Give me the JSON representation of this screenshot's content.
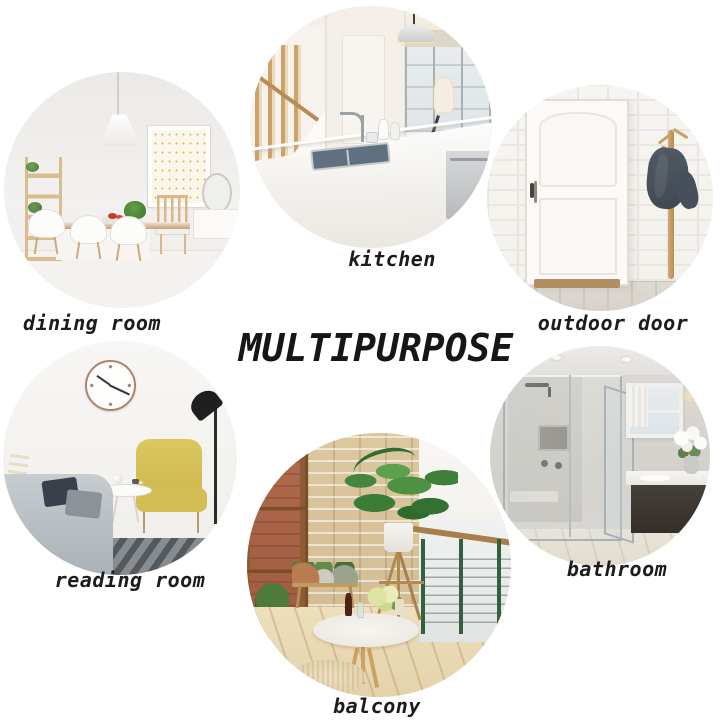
{
  "title": "MULTIPURPOSE",
  "rooms": [
    {
      "label": "dining room"
    },
    {
      "label": "kitchen"
    },
    {
      "label": "outdoor door"
    },
    {
      "label": "reading room"
    },
    {
      "label": "bathroom"
    },
    {
      "label": "balcony"
    }
  ],
  "colors": {
    "background": "#ffffff",
    "text": "#1c1c1c",
    "accent_wood": "#c49a63",
    "accent_yellow": "#d8c35a",
    "accent_green": "#4f9143"
  }
}
